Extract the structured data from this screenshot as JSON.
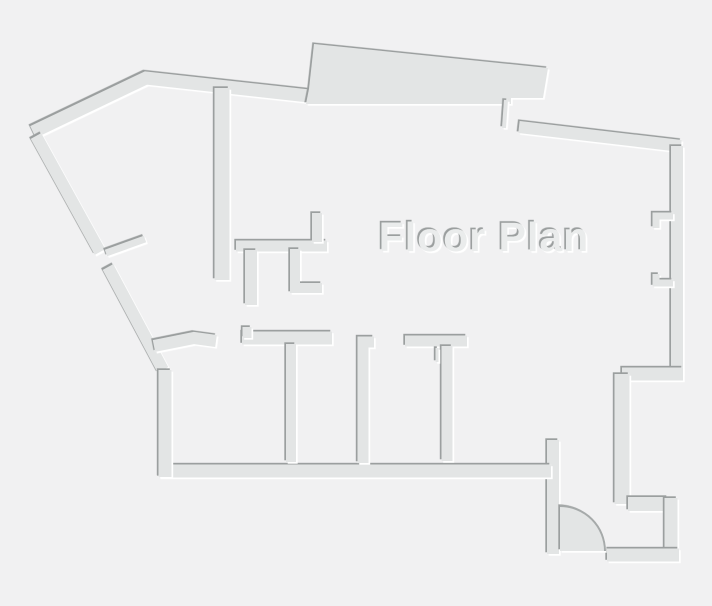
{
  "title": {
    "text": "Floor Plan"
  },
  "colors": {
    "background": "#f1f1f2",
    "wall": "#e3e5e5",
    "shadow": "#9b9f9f",
    "highlight": "#ffffff",
    "text_fill": "#eaecec",
    "door_arc": "#a6aaaa",
    "door_fill": "#e3e5e5"
  },
  "floor_plan": {
    "walls": [
      {
        "name": "outer-wall-top-left",
        "d": "M 33,132 L 146,78 L 309,96",
        "w": 13
      },
      {
        "name": "outer-wall-diagonal-upper",
        "d": "M 36,136 L 100,252",
        "w": 12
      },
      {
        "name": "outer-wall-diagonal-lower",
        "d": "M 108,267 L 163,370",
        "w": 12
      },
      {
        "name": "door-leaf-diagonal",
        "d": "M 106,253 L 145,239",
        "w": 7
      },
      {
        "name": "balcony-slab",
        "d": "M 306,104 L 309,89 L 314,44 L 548,68 L 543,98 L 511,98 L 511,104 Z",
        "fill": true
      },
      {
        "name": "wall-stub-top",
        "d": "M 506,100 L 504,128",
        "w": 4
      },
      {
        "name": "outer-wall-top-right",
        "d": "M 519,127 L 681,146",
        "w": 12
      },
      {
        "name": "outer-wall-right",
        "d": "M 677,146 L 677,374",
        "w": 12
      },
      {
        "name": "window-jamb-upper",
        "d": "M 673,216 L 656,216 L 656,228",
        "w": 7
      },
      {
        "name": "window-jamb-lower",
        "d": "M 673,283 L 656,283 L 656,274",
        "w": 7
      },
      {
        "name": "wall-step-right",
        "d": "M 683,374 L 622,374",
        "w": 13
      },
      {
        "name": "outer-wall-right-lower",
        "d": "M 622,374 L 622,504",
        "w": 15
      },
      {
        "name": "closet-wall-top",
        "d": "M 628,504 L 668,504",
        "w": 14
      },
      {
        "name": "closet-wall-right",
        "d": "M 671,498 L 671,554",
        "w": 13
      },
      {
        "name": "outer-wall-bottom-right",
        "d": "M 679,555 L 607,555",
        "w": 13
      },
      {
        "name": "entry-wall-left",
        "d": "M 553,440 L 553,554",
        "w": 12
      },
      {
        "name": "outer-wall-bottom",
        "d": "M 159,471 L 551,471",
        "w": 13
      },
      {
        "name": "outer-wall-left",
        "d": "M 165,370 L 165,477",
        "w": 13
      },
      {
        "name": "room-wall-angled",
        "d": "M 154,346 L 194,338 L 216,341",
        "w": 12
      },
      {
        "name": "room-wall-top-1",
        "d": "M 242,338 L 332,338",
        "w": 13
      },
      {
        "name": "door-jamb-room-1",
        "d": "M 247,327 L 247,338",
        "w": 9
      },
      {
        "name": "room-divider-1",
        "d": "M 291,344 L 291,462",
        "w": 10
      },
      {
        "name": "room-divider-2",
        "d": "M 374,342 L 363,342 L 363,463",
        "w": 11
      },
      {
        "name": "room-wall-top-2",
        "d": "M 405,341 L 467,341",
        "w": 11
      },
      {
        "name": "room-divider-3",
        "d": "M 447,346 L 447,461",
        "w": 11
      },
      {
        "name": "door-leaf-room-3",
        "d": "M 437,348 L 437,362",
        "w": 3
      },
      {
        "name": "corridor-wall",
        "d": "M 222,88 L 222,280",
        "w": 15
      },
      {
        "name": "small-room-wall-h",
        "d": "M 236,246 L 327,246",
        "w": 11
      },
      {
        "name": "small-room-stub-top",
        "d": "M 317,213 L 317,242",
        "w": 10
      },
      {
        "name": "small-room-stub-left",
        "d": "M 251,250 L 251,305",
        "w": 12
      },
      {
        "name": "small-room-stub-right",
        "d": "M 295,249 L 295,288 L 322,288",
        "w": 10
      }
    ],
    "door": {
      "leaf_d": "M 560,551 L 560,506 A 45,45 0 0 1 605,551 Z",
      "arc_d": "M 560,506 A 45,45 0 0 1 605,551"
    },
    "title_position": {
      "x": 484,
      "y": 251
    }
  }
}
